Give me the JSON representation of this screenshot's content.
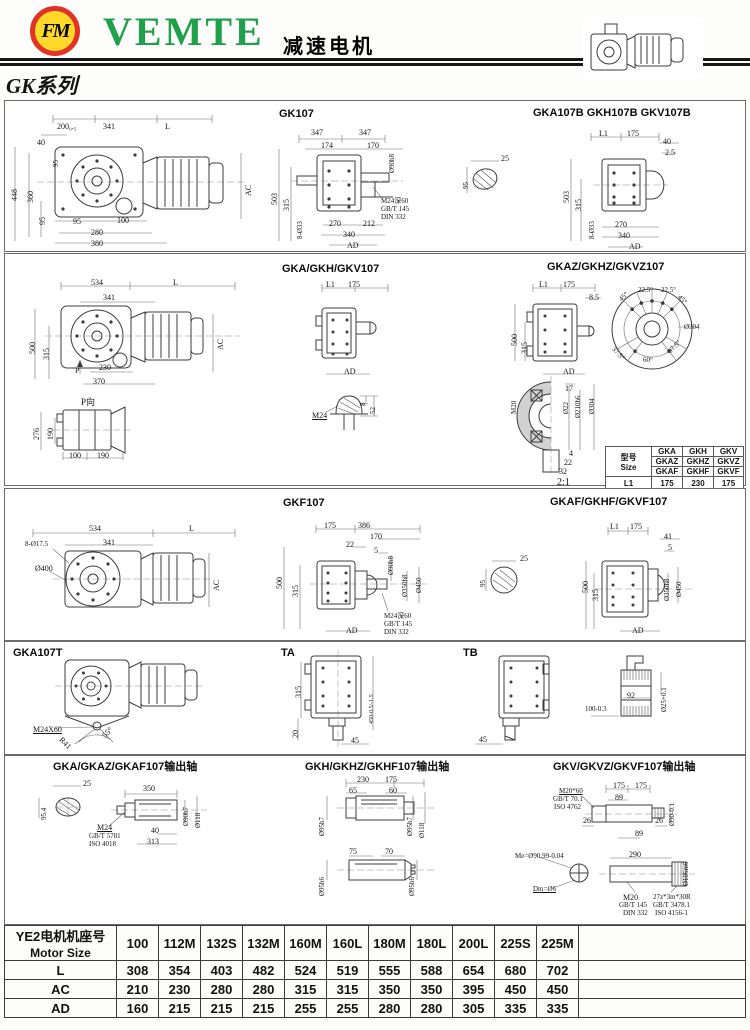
{
  "header": {
    "brand": "VEMTE",
    "logo_text": "FM",
    "product_title": "减速电机",
    "series_title": "GK系列"
  },
  "panels": {
    "r1c1": {
      "labels": [
        {
          "t": "200₀.₅",
          "x": 50,
          "y": 22
        },
        {
          "t": "341",
          "x": 96,
          "y": 22
        },
        {
          "t": "L",
          "x": 158,
          "y": 22
        },
        {
          "t": "40",
          "x": 30,
          "y": 38
        },
        {
          "t": "95",
          "x": 46,
          "y": 66,
          "r": -90,
          "s": 7
        },
        {
          "t": "448",
          "x": 4,
          "y": 100,
          "r": -90
        },
        {
          "t": "360",
          "x": 20,
          "y": 102,
          "r": -90
        },
        {
          "t": "95",
          "x": 32,
          "y": 124,
          "r": -90
        },
        {
          "t": "AC",
          "x": 238,
          "y": 95,
          "r": -90
        },
        {
          "t": "95",
          "x": 66,
          "y": 117
        },
        {
          "t": "100",
          "x": 110,
          "y": 116
        },
        {
          "t": "280",
          "x": 84,
          "y": 128
        },
        {
          "t": "380",
          "x": 84,
          "y": 139
        }
      ]
    },
    "r1c2": {
      "title": "GK107",
      "labels": [
        {
          "t": "347",
          "x": 48,
          "y": 28
        },
        {
          "t": "347",
          "x": 96,
          "y": 28
        },
        {
          "t": "174",
          "x": 58,
          "y": 41
        },
        {
          "t": "170",
          "x": 104,
          "y": 41
        },
        {
          "t": "Ø90h8",
          "x": 126,
          "y": 72,
          "r": -90,
          "s": 7
        },
        {
          "t": "503",
          "x": 8,
          "y": 104,
          "r": -90
        },
        {
          "t": "315",
          "x": 20,
          "y": 110,
          "r": -90
        },
        {
          "t": "8-Ø33",
          "x": 34,
          "y": 138,
          "r": -90,
          "s": 7
        },
        {
          "t": "270",
          "x": 66,
          "y": 119
        },
        {
          "t": "212",
          "x": 100,
          "y": 119
        },
        {
          "t": "340",
          "x": 80,
          "y": 130
        },
        {
          "t": "AD",
          "x": 84,
          "y": 141
        },
        {
          "t": "M24深60",
          "x": 118,
          "y": 97,
          "s": 7
        },
        {
          "t": "GB/T 145",
          "x": 118,
          "y": 105,
          "s": 7
        },
        {
          "t": "DIN 332",
          "x": 118,
          "y": 113,
          "s": 7
        }
      ]
    },
    "r1c3": {
      "title": "GKA107B  GKH107B  GKV107B",
      "labels": [
        {
          "t": "25",
          "x": 38,
          "y": 54
        },
        {
          "t": "95",
          "x": 0,
          "y": 88,
          "r": -90,
          "s": 7
        },
        {
          "t": "L1",
          "x": 136,
          "y": 29
        },
        {
          "t": "175",
          "x": 164,
          "y": 29
        },
        {
          "t": "40",
          "x": 200,
          "y": 37
        },
        {
          "t": "2.5",
          "x": 202,
          "y": 48
        },
        {
          "t": "503",
          "x": 100,
          "y": 102,
          "r": -90
        },
        {
          "t": "315",
          "x": 112,
          "y": 110,
          "r": -90
        },
        {
          "t": "8-Ø33",
          "x": 126,
          "y": 138,
          "r": -90,
          "s": 7
        },
        {
          "t": "270",
          "x": 152,
          "y": 120
        },
        {
          "t": "340",
          "x": 155,
          "y": 131
        },
        {
          "t": "AD",
          "x": 166,
          "y": 142
        }
      ]
    },
    "r2c1": {
      "labels": [
        {
          "t": "534",
          "x": 86,
          "y": 25
        },
        {
          "t": "L",
          "x": 168,
          "y": 25
        },
        {
          "t": "341",
          "x": 98,
          "y": 40
        },
        {
          "t": "500",
          "x": 24,
          "y": 100,
          "r": -90
        },
        {
          "t": "315",
          "x": 38,
          "y": 106,
          "r": -90
        },
        {
          "t": "AC",
          "x": 212,
          "y": 96,
          "r": -90
        },
        {
          "t": "P",
          "x": 70,
          "y": 113
        },
        {
          "t": "230",
          "x": 94,
          "y": 110
        },
        {
          "t": "370",
          "x": 88,
          "y": 124
        },
        {
          "t": "P向",
          "x": 76,
          "y": 144,
          "s": 9,
          "n": "p-view-label"
        },
        {
          "t": "276",
          "x": 28,
          "y": 186,
          "r": -90
        },
        {
          "t": "190",
          "x": 42,
          "y": 186,
          "r": -90
        },
        {
          "t": "100",
          "x": 64,
          "y": 198
        },
        {
          "t": "190",
          "x": 92,
          "y": 198
        }
      ]
    },
    "r2c2": {
      "title": "GKA/GKH/GKV107",
      "labels": [
        {
          "t": "L1",
          "x": 56,
          "y": 27
        },
        {
          "t": "175",
          "x": 78,
          "y": 27
        },
        {
          "t": "AD",
          "x": 74,
          "y": 114
        },
        {
          "t": "8",
          "x": 90,
          "y": 152,
          "r": -90,
          "s": 7
        },
        {
          "t": "52",
          "x": 100,
          "y": 160,
          "r": -90,
          "s": 7
        },
        {
          "t": "M24",
          "x": 42,
          "y": 158,
          "u": true
        }
      ]
    },
    "r2c3": {
      "title": "GKAZ/GKHZ/GKVZ107",
      "labels": [
        {
          "t": "L1",
          "x": 54,
          "y": 27
        },
        {
          "t": "175",
          "x": 78,
          "y": 27
        },
        {
          "t": "8.5",
          "x": 104,
          "y": 40
        },
        {
          "t": "500",
          "x": 26,
          "y": 92,
          "r": -90
        },
        {
          "t": "315",
          "x": 36,
          "y": 100,
          "r": -90
        },
        {
          "t": "AD",
          "x": 78,
          "y": 114
        },
        {
          "t": "45°",
          "x": 133,
          "y": 44,
          "r": -45,
          "s": 7
        },
        {
          "t": "22.5°",
          "x": 153,
          "y": 33,
          "s": 7
        },
        {
          "t": "22.5°",
          "x": 176,
          "y": 33,
          "s": 7
        },
        {
          "t": "45°",
          "x": 196,
          "y": 40,
          "r": 45,
          "s": 7
        },
        {
          "t": "Ø304",
          "x": 199,
          "y": 70,
          "s": 7
        },
        {
          "t": "37.5°",
          "x": 130,
          "y": 92,
          "r": 45,
          "s": 7
        },
        {
          "t": "60°",
          "x": 158,
          "y": 103,
          "s": 7
        },
        {
          "t": "37.5°",
          "x": 182,
          "y": 96,
          "r": -45,
          "s": 7
        },
        {
          "t": "17",
          "x": 80,
          "y": 131
        },
        {
          "t": "M20",
          "x": 26,
          "y": 160,
          "r": -90,
          "s": 7
        },
        {
          "t": "Ø22",
          "x": 78,
          "y": 160,
          "r": -90,
          "s": 7
        },
        {
          "t": "Ø210h6",
          "x": 90,
          "y": 164,
          "r": -90,
          "s": 7
        },
        {
          "t": "Ø304",
          "x": 104,
          "y": 160,
          "r": -90,
          "s": 7
        },
        {
          "t": "4",
          "x": 84,
          "y": 196
        },
        {
          "t": "22",
          "x": 79,
          "y": 205
        },
        {
          "t": "32",
          "x": 74,
          "y": 214
        },
        {
          "t": "2:1",
          "x": 72,
          "y": 224,
          "s": 10,
          "n": "scale-label"
        }
      ]
    },
    "r3c1": {
      "labels": [
        {
          "t": "534",
          "x": 84,
          "y": 36
        },
        {
          "t": "L",
          "x": 184,
          "y": 36
        },
        {
          "t": "341",
          "x": 98,
          "y": 50
        },
        {
          "t": "8-Ø17.5",
          "x": 20,
          "y": 52,
          "s": 7
        },
        {
          "t": "Ø400",
          "x": 30,
          "y": 76
        },
        {
          "t": "AC",
          "x": 208,
          "y": 102,
          "r": -90
        }
      ]
    },
    "r3c2": {
      "title": "GKF107",
      "labels": [
        {
          "t": "175",
          "x": 54,
          "y": 33
        },
        {
          "t": "386",
          "x": 88,
          "y": 33
        },
        {
          "t": "170",
          "x": 100,
          "y": 44
        },
        {
          "t": "22",
          "x": 76,
          "y": 52
        },
        {
          "t": "5",
          "x": 104,
          "y": 58
        },
        {
          "t": "500",
          "x": 6,
          "y": 100,
          "r": -90
        },
        {
          "t": "315",
          "x": 22,
          "y": 108,
          "r": -90
        },
        {
          "t": "Ø90h8",
          "x": 118,
          "y": 86,
          "r": -90,
          "s": 7
        },
        {
          "t": "Ø350h8",
          "x": 132,
          "y": 108,
          "r": -90,
          "s": 7
        },
        {
          "t": "Ø450",
          "x": 146,
          "y": 104,
          "r": -90,
          "s": 7
        },
        {
          "t": "AD",
          "x": 76,
          "y": 138
        },
        {
          "t": "M24深60",
          "x": 114,
          "y": 124,
          "s": 7
        },
        {
          "t": "GB/T 145",
          "x": 114,
          "y": 132,
          "s": 7
        },
        {
          "t": "DIN 332",
          "x": 114,
          "y": 140,
          "s": 7
        }
      ]
    },
    "r3c3": {
      "title": "GKAF/GKHF/GKVF107",
      "labels": [
        {
          "t": "25",
          "x": 40,
          "y": 66
        },
        {
          "t": "95",
          "x": 0,
          "y": 98,
          "r": -90,
          "s": 7
        },
        {
          "t": "L1",
          "x": 130,
          "y": 34
        },
        {
          "t": "175",
          "x": 150,
          "y": 34
        },
        {
          "t": "41",
          "x": 184,
          "y": 44
        },
        {
          "t": "5",
          "x": 188,
          "y": 55
        },
        {
          "t": "500",
          "x": 102,
          "y": 104,
          "r": -90
        },
        {
          "t": "315",
          "x": 112,
          "y": 112,
          "r": -90
        },
        {
          "t": "Ø350h8",
          "x": 184,
          "y": 112,
          "r": -90,
          "s": 7
        },
        {
          "t": "Ø450",
          "x": 196,
          "y": 108,
          "r": -90,
          "s": 7
        },
        {
          "t": "AD",
          "x": 152,
          "y": 138
        }
      ]
    },
    "r4c1": {
      "title": "GKA107T",
      "labels": [
        {
          "t": "M24X60",
          "x": 28,
          "y": 84,
          "u": true
        },
        {
          "t": "R41",
          "x": 58,
          "y": 94,
          "r": 45
        },
        {
          "t": "55°",
          "x": 96,
          "y": 92,
          "r": -45
        }
      ]
    },
    "r4c2": {
      "title": "TA",
      "labels": [
        {
          "t": "315",
          "x": 18,
          "y": 56,
          "r": -90
        },
        {
          "t": "20",
          "x": 15,
          "y": 96,
          "r": -90
        },
        {
          "t": "450-0.5/-1.5",
          "x": 92,
          "y": 82,
          "r": -90,
          "s": 6
        },
        {
          "t": "45",
          "x": 74,
          "y": 95
        }
      ]
    },
    "r4c3": {
      "title": "TB",
      "labels": [
        {
          "t": "45",
          "x": 24,
          "y": 94
        }
      ]
    },
    "r4c4": {
      "labels": [
        {
          "t": "100-0.3",
          "x": 22,
          "y": 64,
          "s": 7
        },
        {
          "t": "92",
          "x": 64,
          "y": 50
        },
        {
          "t": "Ø25+0.1",
          "x": 98,
          "y": 70,
          "r": -90,
          "s": 7
        }
      ]
    },
    "r5c1": {
      "title": "GKA/GKAZ/GKAF107输出轴",
      "labels": [
        {
          "t": "25",
          "x": 78,
          "y": 24
        },
        {
          "t": "95.4",
          "x": 36,
          "y": 64,
          "r": -90,
          "s": 7
        },
        {
          "t": "350",
          "x": 138,
          "y": 29
        },
        {
          "t": "M24",
          "x": 92,
          "y": 68,
          "u": true
        },
        {
          "t": "GB/T 5781",
          "x": 84,
          "y": 77,
          "s": 7
        },
        {
          "t": "ISO 4018",
          "x": 84,
          "y": 85,
          "s": 7
        },
        {
          "t": "40",
          "x": 146,
          "y": 71
        },
        {
          "t": "313",
          "x": 142,
          "y": 82
        },
        {
          "t": "Ø90h7",
          "x": 178,
          "y": 70,
          "r": -90,
          "s": 7
        },
        {
          "t": "Ø118",
          "x": 190,
          "y": 72,
          "r": -90,
          "s": 7
        }
      ]
    },
    "r5c2": {
      "title": "GKH/GKHZ/GKHF107输出轴",
      "labels": [
        {
          "t": "230",
          "x": 60,
          "y": 20
        },
        {
          "t": "175",
          "x": 88,
          "y": 20
        },
        {
          "t": "65",
          "x": 52,
          "y": 31
        },
        {
          "t": "60",
          "x": 92,
          "y": 31
        },
        {
          "t": "Ø95h7",
          "x": 22,
          "y": 80,
          "r": -90,
          "s": 7
        },
        {
          "t": "Ø95h7",
          "x": 110,
          "y": 80,
          "r": -90,
          "s": 7
        },
        {
          "t": "Ø118",
          "x": 122,
          "y": 82,
          "r": -90,
          "s": 7
        },
        {
          "t": "75",
          "x": 52,
          "y": 92
        },
        {
          "t": "70",
          "x": 88,
          "y": 92
        },
        {
          "t": "Ø95h6",
          "x": 22,
          "y": 140,
          "r": -90,
          "s": 7
        },
        {
          "t": "Ø95h6",
          "x": 112,
          "y": 140,
          "r": -90,
          "s": 7
        }
      ]
    },
    "r5c3": {
      "title": "GKV/GKVZ/GKVF107输出轴",
      "labels": [
        {
          "t": "M20*60",
          "x": 72,
          "y": 32,
          "u": true,
          "s": 7
        },
        {
          "t": "GB/T 70.1",
          "x": 66,
          "y": 40,
          "s": 7
        },
        {
          "t": "ISO 4762",
          "x": 67,
          "y": 48,
          "s": 7
        },
        {
          "t": "175",
          "x": 126,
          "y": 26
        },
        {
          "t": "175",
          "x": 148,
          "y": 26
        },
        {
          "t": "89",
          "x": 128,
          "y": 38
        },
        {
          "t": "Ø90-0.1",
          "x": 182,
          "y": 70,
          "r": -90,
          "s": 7
        },
        {
          "t": "26",
          "x": 96,
          "y": 61
        },
        {
          "t": "26",
          "x": 168,
          "y": 61
        },
        {
          "t": "89",
          "x": 148,
          "y": 74
        },
        {
          "t": "Ø105m6",
          "x": 196,
          "y": 130,
          "r": -90,
          "s": 7
        },
        {
          "t": "290",
          "x": 142,
          "y": 95
        },
        {
          "t": "Me=Ø90.99-0.04",
          "x": 28,
          "y": 97,
          "s": 7
        },
        {
          "t": "Dm=Ø6",
          "x": 46,
          "y": 130,
          "u": true,
          "s": 7
        },
        {
          "t": "M20",
          "x": 136,
          "y": 138
        },
        {
          "t": "GB/T 145",
          "x": 132,
          "y": 146,
          "s": 7
        },
        {
          "t": "DIN 332",
          "x": 136,
          "y": 154,
          "s": 7
        },
        {
          "t": "27z*3m*30R",
          "x": 166,
          "y": 138,
          "s": 7
        },
        {
          "t": "GB/T 3478.1",
          "x": 166,
          "y": 146,
          "s": 7
        },
        {
          "t": "ISO 4156-1",
          "x": 168,
          "y": 154,
          "s": 7
        }
      ]
    }
  },
  "size_table": {
    "header_cn": "型号",
    "header_en": "Size",
    "rows": [
      [
        "GKA",
        "GKH",
        "GKV"
      ],
      [
        "GKAZ",
        "GKHZ",
        "GKVZ"
      ],
      [
        "GKAF",
        "GKHF",
        "GKVF"
      ]
    ],
    "l1_label": "L1",
    "l1_values": [
      "175",
      "230",
      "175"
    ]
  },
  "motor_table": {
    "header_cn": "YE2电机机座号",
    "header_en": "Motor Size",
    "sizes": [
      "100",
      "112M",
      "132S",
      "132M",
      "160M",
      "160L",
      "180M",
      "180L",
      "200L",
      "225S",
      "225M"
    ],
    "rows": [
      {
        "label": "L",
        "values": [
          "308",
          "354",
          "403",
          "482",
          "524",
          "519",
          "555",
          "588",
          "654",
          "680",
          "702"
        ]
      },
      {
        "label": "AC",
        "values": [
          "210",
          "230",
          "280",
          "280",
          "315",
          "315",
          "350",
          "350",
          "395",
          "450",
          "450"
        ]
      },
      {
        "label": "AD",
        "values": [
          "160",
          "215",
          "215",
          "215",
          "255",
          "255",
          "280",
          "280",
          "305",
          "335",
          "335"
        ]
      }
    ]
  }
}
